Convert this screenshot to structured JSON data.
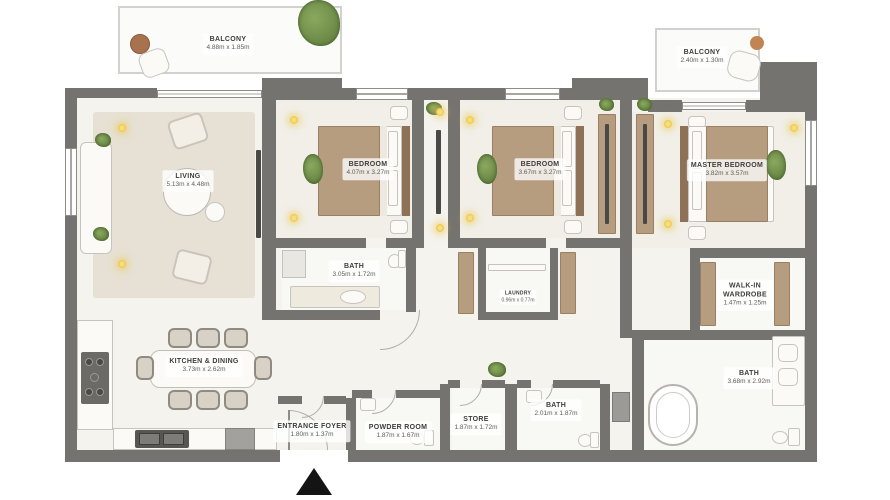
{
  "plan": {
    "colors": {
      "wall": "#757370",
      "floor": "#f4f3ee",
      "wood_accent": "#b69d80",
      "plant_green": "#6f8c4d",
      "ceiling_light_yellow": "#ecc94f",
      "entrance_arrow_black": "#141414"
    },
    "icons": {
      "entrance_arrow": "triangle-up",
      "ceiling_light": "glow-dot",
      "plant": "foliage-blob"
    },
    "rooms": {
      "balcony_left": {
        "name": "BALCONY",
        "dims": "4.88m x 1.85m"
      },
      "balcony_right": {
        "name": "BALCONY",
        "dims": "2.40m x 1.30m"
      },
      "living": {
        "name": "LIVING",
        "dims": "5.13m x 4.48m"
      },
      "bedroom1": {
        "name": "BEDROOM",
        "dims": "4.07m x 3.27m"
      },
      "bedroom2": {
        "name": "BEDROOM",
        "dims": "3.67m x 3.27m"
      },
      "master_bedroom": {
        "name": "MASTER BEDROOM",
        "dims": "3.82m x 3.57m"
      },
      "bath1": {
        "name": "BATH",
        "dims": "3.05m x 1.72m"
      },
      "laundry": {
        "name": "LAUNDRY",
        "dims": "0.96m x 0.77m"
      },
      "walk_in_wardrobe": {
        "name": "WALK-IN WARDROBE",
        "dims": "1.47m x 1.25m"
      },
      "kitchen_dining": {
        "name": "KITCHEN & DINING",
        "dims": "3.73m x 2.62m"
      },
      "entrance_foyer": {
        "name": "ENTRANCE FOYER",
        "dims": "1.80m x 1.37m"
      },
      "powder_room": {
        "name": "POWDER ROOM",
        "dims": "1.87m x 1.67m"
      },
      "store": {
        "name": "STORE",
        "dims": "1.87m x 1.72m"
      },
      "bath2": {
        "name": "BATH",
        "dims": "2.01m x 1.87m"
      },
      "master_bath": {
        "name": "BATH",
        "dims": "3.68m x 2.92m"
      }
    }
  }
}
